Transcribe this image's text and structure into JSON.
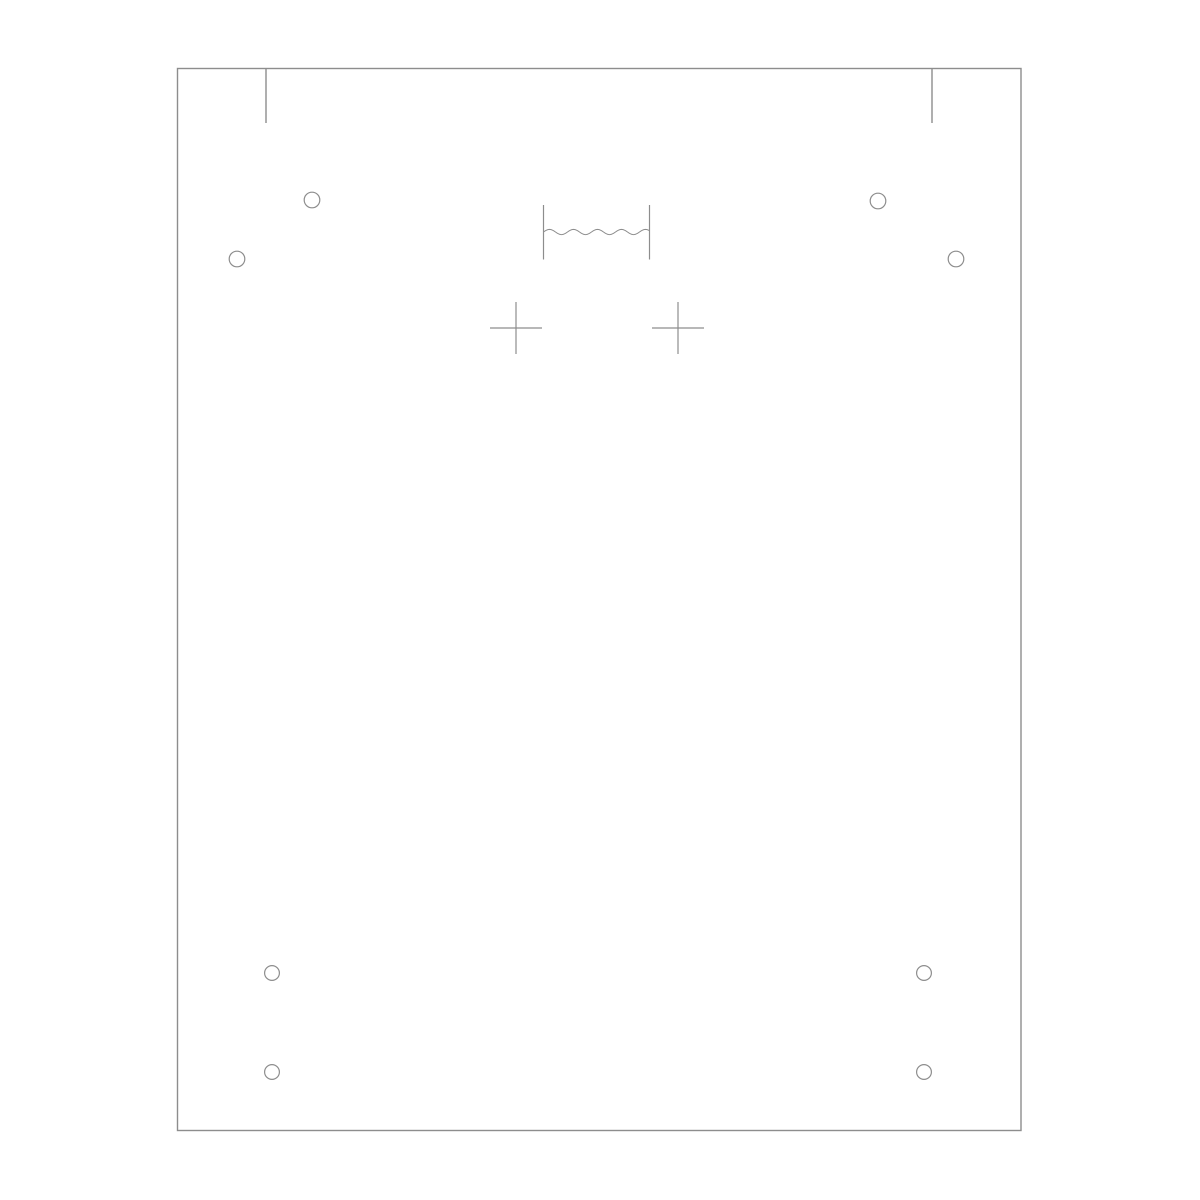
{
  "canvas": {
    "width": 1200,
    "height": 1200,
    "background_color": "#ffffff"
  },
  "drawing": {
    "stroke_color": "#8d8d8d",
    "outline_stroke_width": 1.4,
    "detail_stroke_width": 1.2,
    "panel_outline": {
      "x": 177.5,
      "y": 68.5,
      "width": 843.5,
      "height": 1062
    },
    "top_notch_ticks": [
      {
        "x": 266,
        "y1": 68.5,
        "y2": 123
      },
      {
        "x": 932,
        "y1": 68.5,
        "y2": 123
      }
    ],
    "holes": [
      {
        "cx": 312,
        "cy": 200,
        "r": 7.8
      },
      {
        "cx": 237,
        "cy": 259,
        "r": 7.8
      },
      {
        "cx": 878,
        "cy": 201,
        "r": 7.8
      },
      {
        "cx": 956,
        "cy": 259,
        "r": 7.8
      },
      {
        "cx": 272,
        "cy": 973,
        "r": 7.4
      },
      {
        "cx": 272,
        "cy": 1072,
        "r": 7.4
      },
      {
        "cx": 924,
        "cy": 973,
        "r": 7.4
      },
      {
        "cx": 924,
        "cy": 1072,
        "r": 7.4
      }
    ],
    "crosshairs": [
      {
        "cx": 516,
        "cy": 328,
        "arm": 26
      },
      {
        "cx": 678,
        "cy": 328,
        "arm": 26
      }
    ],
    "break_symbol": {
      "bar_left_x": 543.5,
      "bar_right_x": 649.5,
      "bar_top_y": 205,
      "bar_bottom_y": 259.5,
      "wave_y": 232,
      "wave_amplitude": 2.6,
      "wave_wavelength": 24
    }
  }
}
